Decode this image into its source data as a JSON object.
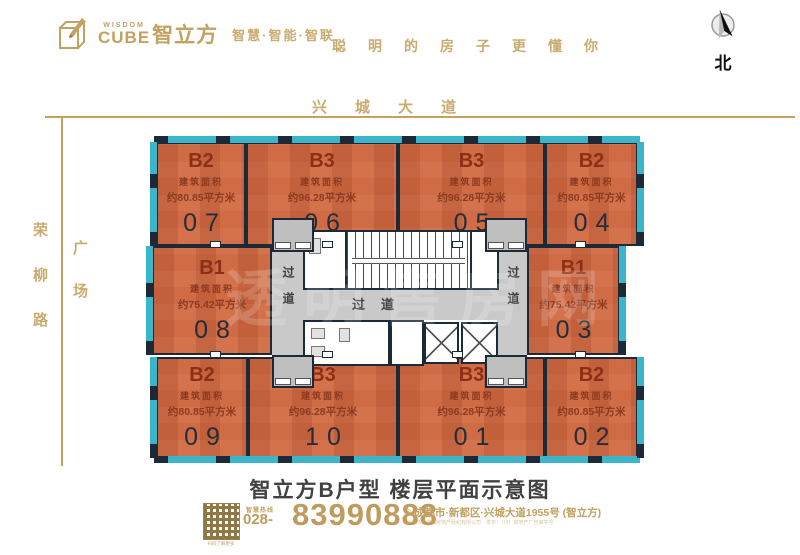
{
  "colors": {
    "gold": "#c2a161",
    "unit_orange": "#cf6b45",
    "wall_navy": "#1c2a38",
    "curtainwall_teal": "#3ab5c9",
    "unit_text_maroon": "#8c3018"
  },
  "header": {
    "logo_en_top": "WISDOM",
    "logo_en_bottom": "CUBE",
    "logo_cn": "智立方",
    "tagline": "智慧·智能·智联",
    "slogan": "聪明的房子更懂你",
    "compass_label": "北"
  },
  "map": {
    "road_top": "兴城大道",
    "road_left": "荣柳路",
    "plaza": "广场",
    "corridor_h": "过道",
    "corridor_left": "过道",
    "corridor_right": "过道",
    "watermark": "透明售房网"
  },
  "units": [
    {
      "id": "07",
      "type": "B2",
      "area_label": "建筑面积",
      "area": "约80.85平方米",
      "number": "07"
    },
    {
      "id": "06",
      "type": "B3",
      "area_label": "建筑面积",
      "area": "约96.28平方米",
      "number": "06"
    },
    {
      "id": "05",
      "type": "B3",
      "area_label": "建筑面积",
      "area": "约96.28平方米",
      "number": "05"
    },
    {
      "id": "04",
      "type": "B2",
      "area_label": "建筑面积",
      "area": "约80.85平方米",
      "number": "04"
    },
    {
      "id": "08",
      "type": "B1",
      "area_label": "建筑面积",
      "area": "约75.42平方米",
      "number": "08"
    },
    {
      "id": "03",
      "type": "B1",
      "area_label": "建筑面积",
      "area": "约75.42平方米",
      "number": "03"
    },
    {
      "id": "09",
      "type": "B2",
      "area_label": "建筑面积",
      "area": "约80.85平方米",
      "number": "09"
    },
    {
      "id": "10",
      "type": "B3",
      "area_label": "建筑面积",
      "area": "约96.28平方米",
      "number": "10"
    },
    {
      "id": "01",
      "type": "B3",
      "area_label": "建筑面积",
      "area": "约96.28平方米",
      "number": "01"
    },
    {
      "id": "02",
      "type": "B2",
      "area_label": "建筑面积",
      "area": "约80.85平方米",
      "number": "02"
    }
  ],
  "footer": {
    "title": "智立方B户型  楼层平面示意图",
    "hotline_label": "智慧热线",
    "phone_prefix": "028-",
    "phone_number": "83990888",
    "address": "成都市·新都区·兴城大道1955号 (智立方)",
    "qr_caption": "扫码了解更多",
    "fine_print": "代理商：成都房地产经纪有限公司　发布：（川）房地产广告审字号"
  }
}
